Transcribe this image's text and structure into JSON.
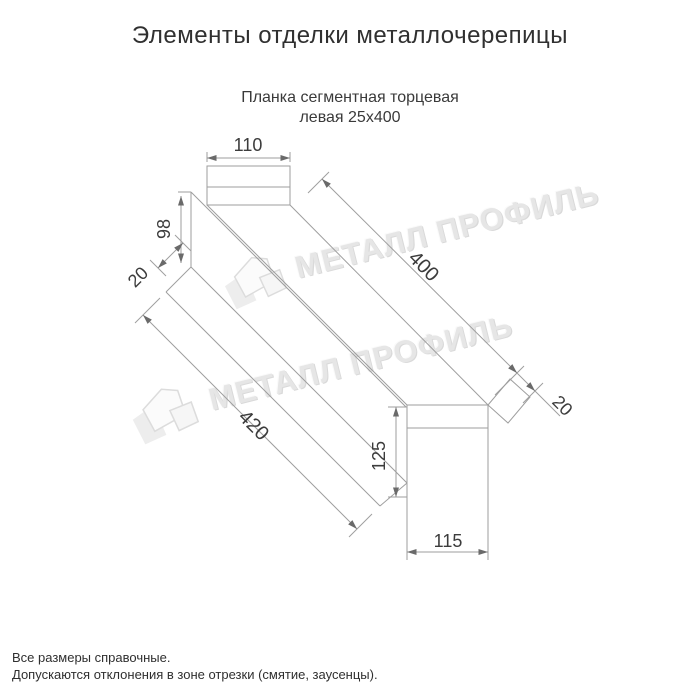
{
  "page": {
    "title": "Элементы отделки металлочерепицы"
  },
  "drawing": {
    "subtitle": {
      "line1": "Планка сегментная торцевая",
      "line2": "левая 25х400"
    },
    "dimensions": {
      "top_width": "110",
      "left_height": "98",
      "left_hem": "20",
      "length_top": "400",
      "length_bottom": "420",
      "right_hem": "20",
      "end_height": "125",
      "end_width": "115"
    }
  },
  "watermark": {
    "text": "МЕТАЛЛ ПРОФИЛЬ",
    "logo": "house-logo",
    "color": "#e6e6e6",
    "angle_deg": -14
  },
  "footer": {
    "line1": "Все размеры справочные.",
    "line2": "Допускаются отклонения в зоне отрезки (смятие, заусенцы)."
  },
  "style": {
    "line_color": "#9e9e9e",
    "dim_text_color": "#3c3c3c",
    "title_color": "#303030",
    "background": "#ffffff"
  }
}
